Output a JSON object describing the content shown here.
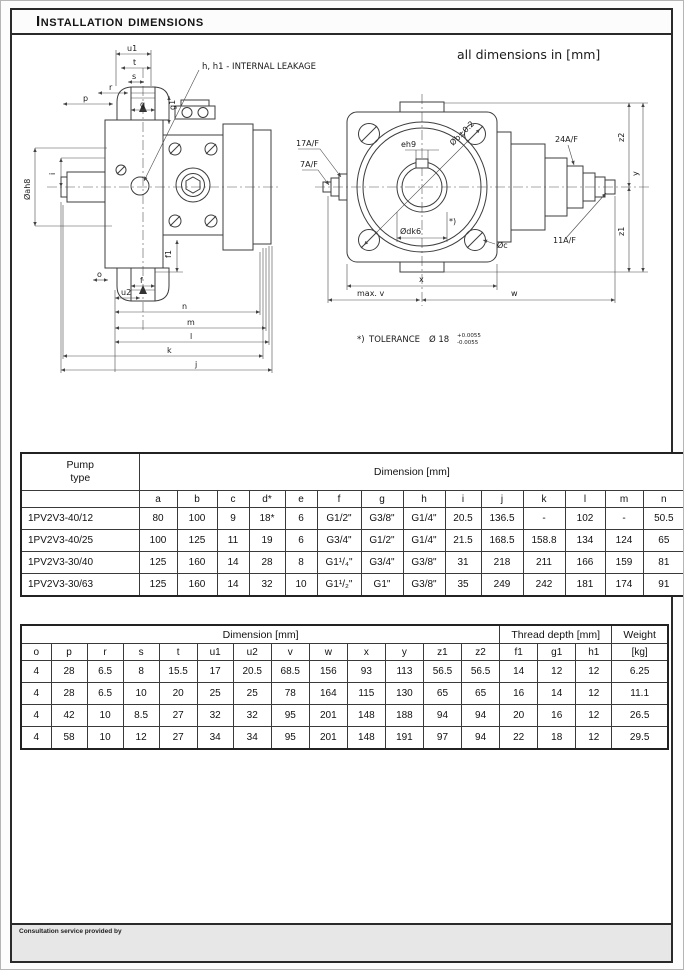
{
  "header": {
    "title": "Installation dimensions"
  },
  "drawing": {
    "units_note": "all dimensions in [mm]",
    "leakage_note": "h, h1 - INTERNAL LEAKAGE",
    "tolerance": {
      "ref": "*)",
      "label": "TOLERANCE",
      "size": "Ø 18",
      "plus": "+0.0055",
      "minus": "-0.0055"
    },
    "side_labels": {
      "u1": "u1",
      "t": "t",
      "s": "s",
      "r": "r",
      "g": "g",
      "g1": "g1",
      "p": "p",
      "i": "i",
      "shaft_dia": "Øah8",
      "o": "o",
      "f": "f",
      "f1": "f1",
      "u2": "u2",
      "n": "n",
      "m": "m",
      "l": "l",
      "k": "k",
      "j": "j"
    },
    "front_labels": {
      "af17": "17A/F",
      "af7": "7A/F",
      "eh9": "eh9",
      "bolt_circle": "Øb±0.2",
      "shaft": "Ødk6",
      "tol_ref": "*)",
      "c": "Øc",
      "af24": "24A/F",
      "af11": "11A/F",
      "z1": "z1",
      "z2": "z2",
      "y": "y",
      "x": "x",
      "max_v": "max. v",
      "w": "w"
    }
  },
  "table1": {
    "corner_header": "Pump\ntype",
    "group_header": "Dimension [mm]",
    "columns": [
      "a",
      "b",
      "c",
      "d*",
      "e",
      "f",
      "g",
      "h",
      "i",
      "j",
      "k",
      "l",
      "m",
      "n"
    ],
    "rows": [
      [
        "1PV2V3-40/12",
        "80",
        "100",
        "9",
        "18*",
        "6",
        "G1/2\"",
        "G3/8\"",
        "G1/4\"",
        "20.5",
        "136.5",
        "-",
        "102",
        "-",
        "50.5"
      ],
      [
        "1PV2V3-40/25",
        "100",
        "125",
        "11",
        "19",
        "6",
        "G3/4\"",
        "G1/2\"",
        "G1/4\"",
        "21.5",
        "168.5",
        "158.8",
        "134",
        "124",
        "65"
      ],
      [
        "1PV2V3-30/40",
        "125",
        "160",
        "14",
        "28",
        "8",
        "G1¹/₄\"",
        "G3/4\"",
        "G3/8\"",
        "31",
        "218",
        "211",
        "166",
        "159",
        "81"
      ],
      [
        "1PV2V3-30/63",
        "125",
        "160",
        "14",
        "32",
        "10",
        "G1¹/₂\"",
        "G1\"",
        "G3/8\"",
        "35",
        "249",
        "242",
        "181",
        "174",
        "91"
      ]
    ]
  },
  "table2": {
    "group_headers": {
      "dimension": "Dimension [mm]",
      "thread": "Thread depth [mm]",
      "weight": "Weight"
    },
    "columns": [
      "o",
      "p",
      "r",
      "s",
      "t",
      "u1",
      "u2",
      "v",
      "w",
      "x",
      "y",
      "z1",
      "z2",
      "f1",
      "g1",
      "h1",
      "[kg]"
    ],
    "rows": [
      [
        "4",
        "28",
        "6.5",
        "8",
        "15.5",
        "17",
        "20.5",
        "68.5",
        "156",
        "93",
        "113",
        "56.5",
        "56.5",
        "14",
        "12",
        "12",
        "6.25"
      ],
      [
        "4",
        "28",
        "6.5",
        "10",
        "20",
        "25",
        "25",
        "78",
        "164",
        "115",
        "130",
        "65",
        "65",
        "16",
        "14",
        "12",
        "11.1"
      ],
      [
        "4",
        "42",
        "10",
        "8.5",
        "27",
        "32",
        "32",
        "95",
        "201",
        "148",
        "188",
        "94",
        "94",
        "20",
        "16",
        "12",
        "26.5"
      ],
      [
        "4",
        "58",
        "10",
        "12",
        "27",
        "34",
        "34",
        "95",
        "201",
        "148",
        "191",
        "97",
        "94",
        "22",
        "18",
        "12",
        "29.5"
      ]
    ]
  },
  "footer": {
    "text": "Consultation service provided by"
  }
}
